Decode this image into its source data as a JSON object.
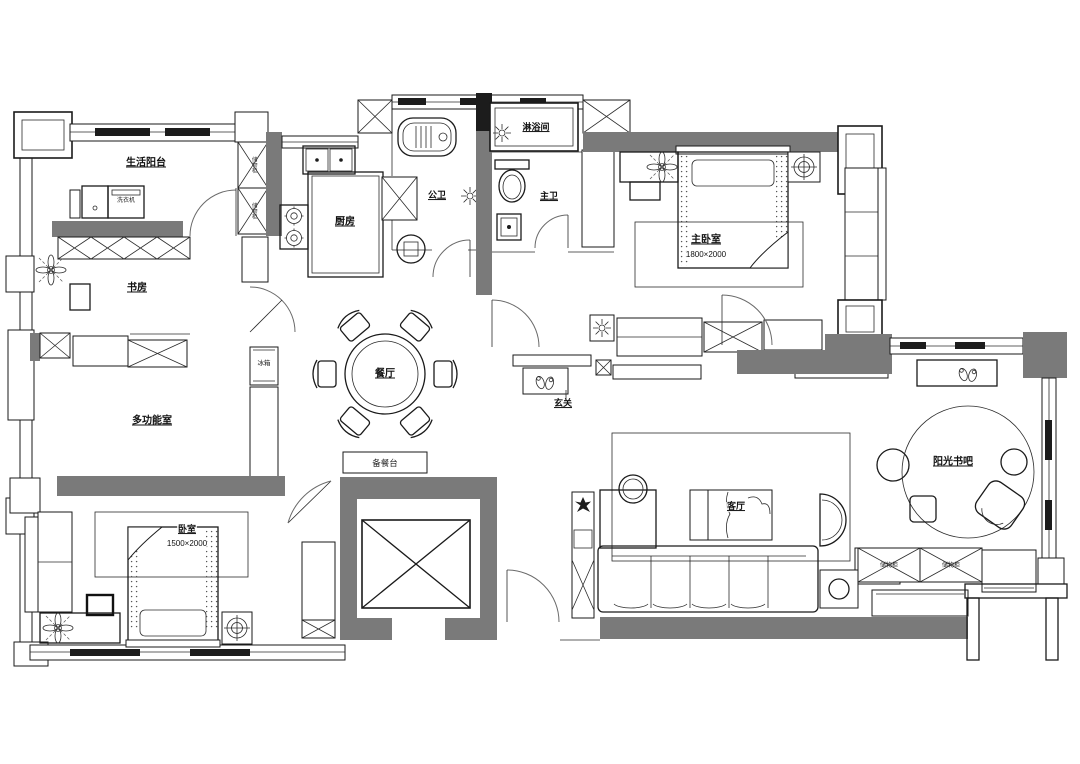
{
  "plan": {
    "name": "apartment-floor-plan",
    "colors": {
      "wall": "#7a7a7a",
      "line": "#1a1a1a",
      "background": "#ffffff"
    },
    "labels": {
      "balcony": "生活阳台",
      "study": "书房",
      "multi_room": "多功能室",
      "kitchen": "厨房",
      "public_bath": "公卫",
      "shower_room": "淋浴间",
      "master_bath": "主卫",
      "master_bedroom": "主卧室",
      "master_bedroom_dim": "1800×2000",
      "dining": "餐厅",
      "foyer": "玄关",
      "serving_counter": "备餐台",
      "living": "客厅",
      "book_bar": "阳光书吧",
      "bedroom": "卧室",
      "bedroom_dim": "1500×2000",
      "fridge": "冰箱",
      "washer": "洗衣机",
      "storage_cabinet_1": "储物柜",
      "storage_cabinet_2": "储物柜",
      "storage_cabinet_3": "储物柜",
      "storage_cabinet_4": "储物柜"
    }
  }
}
